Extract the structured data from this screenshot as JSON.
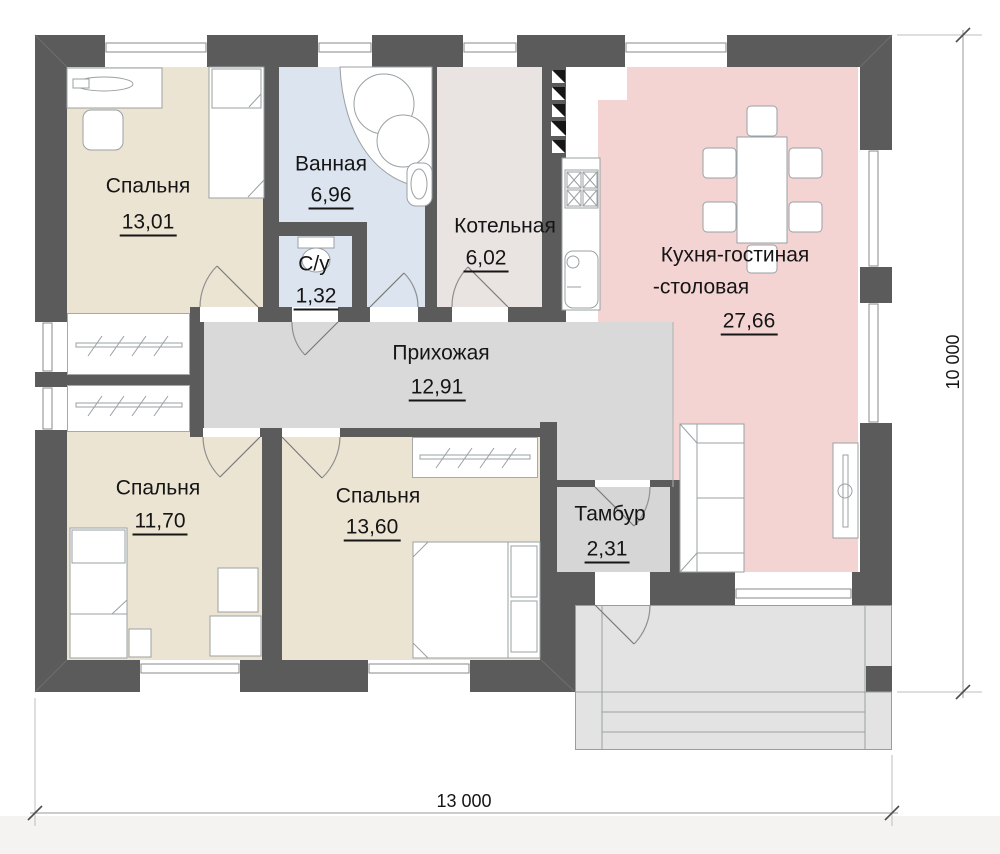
{
  "plan": {
    "rooms": [
      {
        "id": "bedroom-top-left",
        "name": "Спальня",
        "area": "13,01",
        "color": "#ece4d3"
      },
      {
        "id": "bathroom",
        "name": "Ванная",
        "area": "6,96",
        "color": "#dce4ef"
      },
      {
        "id": "wc",
        "name": "С/у",
        "area": "1,32",
        "color": "#dce4ef"
      },
      {
        "id": "boiler-room",
        "name": "Котельная",
        "area": "6,02",
        "color": "#e9e3e2"
      },
      {
        "id": "kitchen-living-dining",
        "name_line1": "Кухня-гостиная",
        "name_line2": "-столовая",
        "area": "27,66",
        "color": "#f3d4d3"
      },
      {
        "id": "hallway",
        "name": "Прихожая",
        "area": "12,91",
        "color": "#d9d9d9"
      },
      {
        "id": "bedroom-bottom-left",
        "name": "Спальня",
        "area": "11,70",
        "color": "#ece4d3"
      },
      {
        "id": "bedroom-bottom-middle",
        "name": "Спальня",
        "area": "13,60",
        "color": "#ece4d3"
      },
      {
        "id": "vestibule",
        "name": "Тамбур",
        "area": "2,31",
        "color": "#d6d6d6"
      }
    ],
    "dimensions": {
      "width": "13 000",
      "height": "10 000"
    },
    "palette": {
      "wall": "#5b5b5b",
      "porch": "#e3e3e3",
      "closet": "#ffffff",
      "outline": "#9aa0a3",
      "dimension_line": "#999999",
      "text": "#151515",
      "vent": "#161616"
    }
  }
}
